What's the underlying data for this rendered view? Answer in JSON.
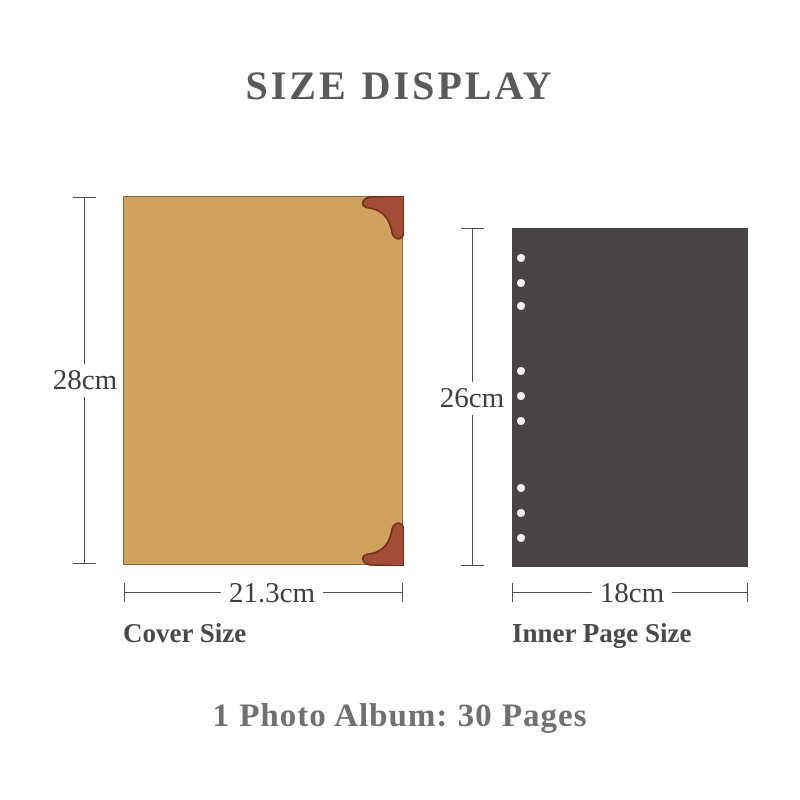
{
  "title": "SIZE DISPLAY",
  "cover": {
    "height_label": "28cm",
    "width_label": "21.3cm",
    "caption": "Cover Size",
    "fill_color": "#d0a15c",
    "border_color": "#84703f",
    "corner_fill": "#a24e36",
    "corner_stroke": "#6e2c1c"
  },
  "inner_page": {
    "height_label": "26cm",
    "width_label": "18cm",
    "caption": "Inner Page Size",
    "fill_color": "#474443",
    "hole_color": "#f4f2f0",
    "hole_count": 9,
    "hole_groups": 3
  },
  "footer": "1 Photo Album: 30 Pages",
  "colors": {
    "background": "#ffffff",
    "dimension_line": "#4f4f4f",
    "dimension_text": "#3e3e3e",
    "title_text": "#5a5a5a",
    "footer_text": "#707070"
  }
}
